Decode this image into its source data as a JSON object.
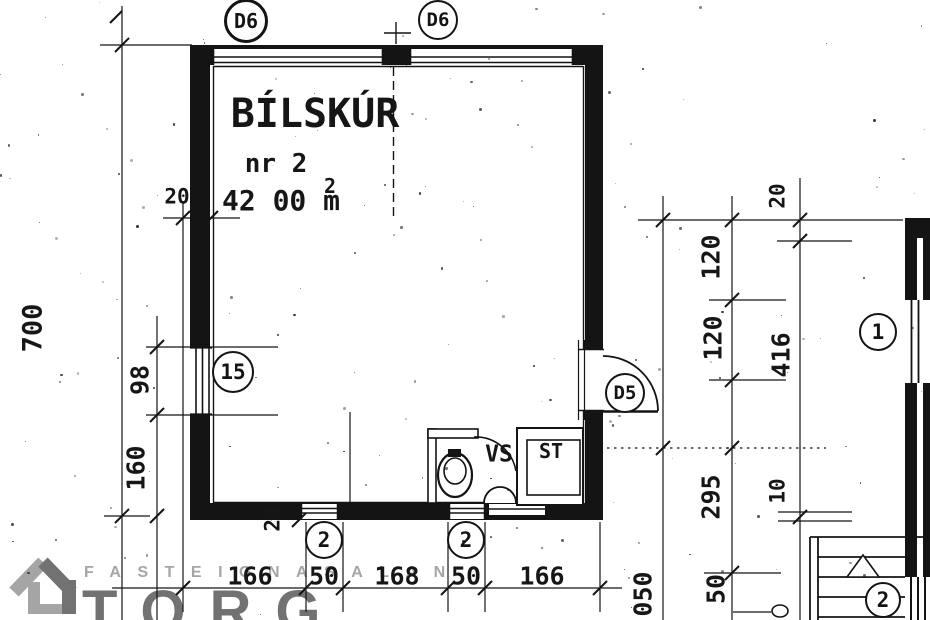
{
  "floor_plan": {
    "room": {
      "name": "BÍLSKÚR",
      "number": "nr 2",
      "area_value": "42 00 m",
      "area_exponent": "2"
    },
    "sub_rooms": {
      "wc": "VS",
      "storage": "ST"
    },
    "markers": {
      "garage_door_left": "D6",
      "garage_door_right": "D6",
      "window_left": "15",
      "door_right": "D5",
      "window_bottom_left": "2",
      "window_bottom_right": "2",
      "neighbor_wall": "1",
      "stairs": "2"
    },
    "dimensions": {
      "left_total_height": "700",
      "left_wall_thickness": "20",
      "left_window": "98",
      "left_lower_segment": "160",
      "bottom_chain": [
        "166",
        "50",
        "168",
        "50",
        "166"
      ],
      "bottom_wall_thickness": "20",
      "right_wall_thickness": "20",
      "right_upper_segment": "120",
      "right_mid_segment": "120",
      "right_total": "416",
      "right_lower_segment": "295",
      "right_small": "10",
      "right_stair_segment": "50",
      "right_partial": "050"
    },
    "watermark": {
      "brand_top": "FASTEIGNASALAN",
      "brand_main": "TORG"
    },
    "colors": {
      "ink": "#141414",
      "paper": "#ffffff",
      "watermark_dark": "#4f4f4f",
      "watermark_light": "#8f8f8f"
    }
  }
}
